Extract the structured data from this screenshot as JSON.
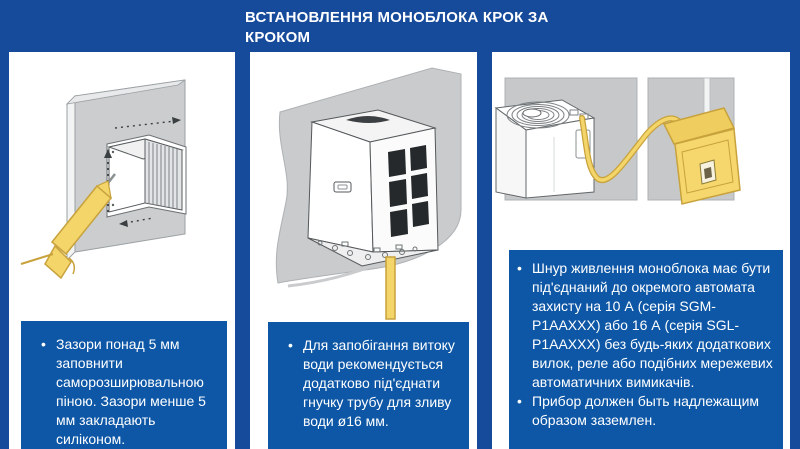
{
  "header": {
    "title": "ВСТАНОВЛЕННЯ МОНОБЛОКА КРОК ЗА КРОКОМ"
  },
  "bullet_glyph": "•",
  "colors": {
    "background_blue": "#164A9B",
    "note_box_blue": "#0D57A6",
    "panel_white": "#FFFFFF",
    "illustration_gray": "#C9CBCD",
    "accent_yellow": "#F3D56A",
    "text_white": "#FFFFFF"
  },
  "steps": [
    {
      "illustration": "wall-opening-with-sealant-gun",
      "notes": [
        "Зазори понад 5 мм заповнити саморозширювальною піною. Зазори менше 5 мм закладають силіконом."
      ]
    },
    {
      "illustration": "monoblock-with-drain-tube",
      "notes": [
        "Для запобігання витоку води рекомендується додатково під'єднати гнучку трубу для зливу води ø16 мм."
      ]
    },
    {
      "illustration": "power-cord-to-breaker-box",
      "notes": [
        "Шнур живлення моноблока має бути під'єднаний до окремого автомата захисту на 10 А (серія SGM-P1AAXXX) або 16 А (серія SGL-P1AAXXX) без будь-яких додаткових вилок, реле або подібних мережевих автоматичних вимикачів.",
        "Прибор должен быть надлежащим образом заземлен."
      ]
    }
  ]
}
